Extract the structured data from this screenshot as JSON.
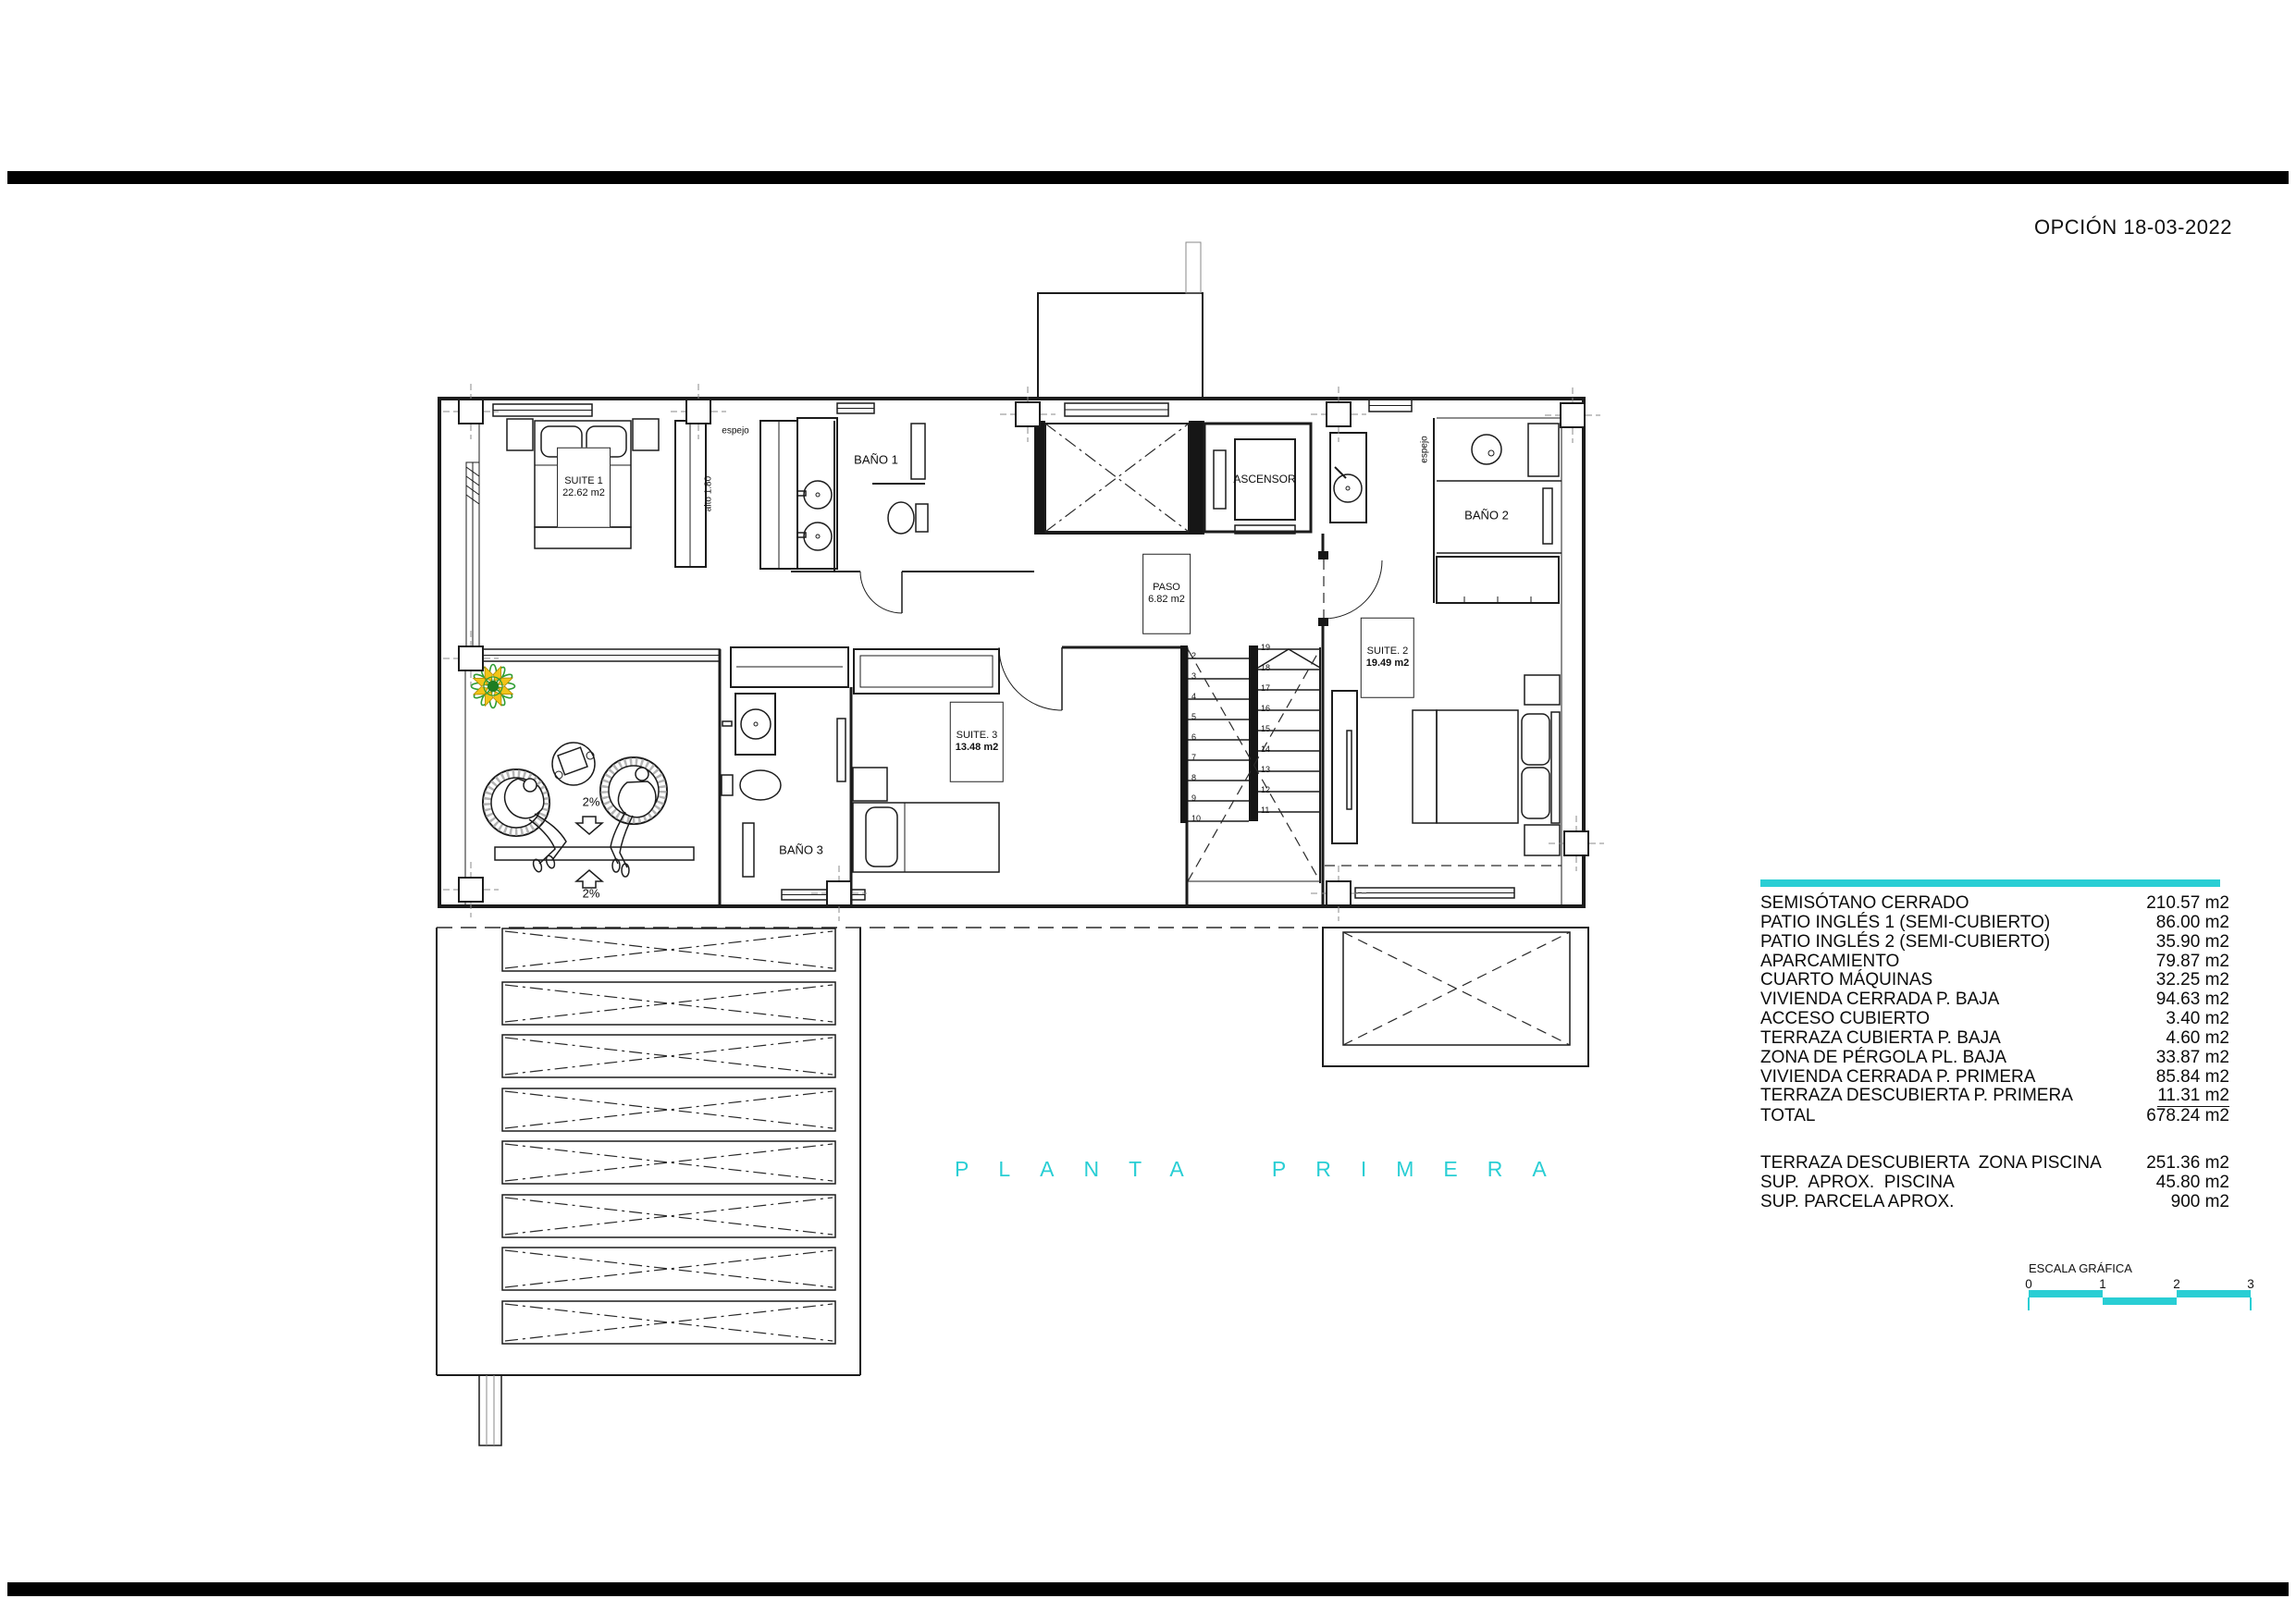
{
  "page": {
    "revision_note": "OPCIÓN 18-03-2022"
  },
  "plan": {
    "title": "PLANTA PRIMERA",
    "rooms": {
      "suite1": {
        "name": "SUITE 1",
        "area": "22.62 m2"
      },
      "bano1": {
        "name": "BAÑO 1"
      },
      "ascensor": {
        "name": "ASCENSOR"
      },
      "bano2": {
        "name": "BAÑO 2"
      },
      "paso": {
        "name": "PASO",
        "area": "6.82 m2"
      },
      "suite2": {
        "name": "SUITE. 2",
        "area": "19.49 m2"
      },
      "suite3": {
        "name": "SUITE. 3",
        "area": "13.48 m2"
      },
      "bano3": {
        "name": "BAÑO 3"
      }
    },
    "annotations": {
      "espejo1": "espejo",
      "espejo2": "espejo",
      "alto": "alto 1.80",
      "slope1": "2%",
      "slope2": "2%"
    },
    "stairs": {
      "left_numbers": [
        "2",
        "3",
        "4",
        "5",
        "6",
        "7",
        "8",
        "9",
        "10"
      ],
      "right_numbers": [
        "19",
        "18",
        "17",
        "16",
        "15",
        "14",
        "13",
        "12",
        "11"
      ]
    }
  },
  "area_table": {
    "rows": [
      {
        "label": "SEMISÓTANO CERRADO",
        "value": "210.57 m2"
      },
      {
        "label": "PATIO INGLÉS 1 (SEMI-CUBIERTO)",
        "value": "86.00 m2"
      },
      {
        "label": "PATIO INGLÉS 2 (SEMI-CUBIERTO)",
        "value": "35.90 m2"
      },
      {
        "label": "APARCAMIENTO",
        "value": "79.87 m2"
      },
      {
        "label": "CUARTO MÁQUINAS",
        "value": "32.25 m2"
      },
      {
        "label": "VIVIENDA CERRADA P. BAJA",
        "value": "94.63 m2"
      },
      {
        "label": "ACCESO CUBIERTO",
        "value": "3.40 m2"
      },
      {
        "label": "TERRAZA CUBIERTA P. BAJA",
        "value": "4.60 m2"
      },
      {
        "label": "ZONA DE PÉRGOLA PL. BAJA",
        "value": "33.87 m2"
      },
      {
        "label": "VIVIENDA CERRADA P. PRIMERA",
        "value": "85.84 m2"
      },
      {
        "label": "TERRAZA DESCUBIERTA P. PRIMERA",
        "value": "11.31 m2",
        "underline": true
      },
      {
        "label": "TOTAL",
        "value": "678.24 m2"
      }
    ],
    "rows2": [
      {
        "label": "TERRAZA DESCUBIERTA  ZONA PISCINA",
        "value": "251.36 m2"
      },
      {
        "label": "SUP.  APROX.  PISCINA",
        "value": "45.80 m2"
      },
      {
        "label": "SUP. PARCELA APROX.",
        "value": "900 m2"
      }
    ]
  },
  "scale": {
    "label": "ESCALA GRÁFICA",
    "ticks": [
      "0",
      "1",
      "2",
      "3"
    ]
  },
  "colors": {
    "accent": "#29ced4",
    "flower_green": "#2f9e33",
    "flower_dark_green": "#1e7d22",
    "flower_yellow": "#f2c417"
  }
}
